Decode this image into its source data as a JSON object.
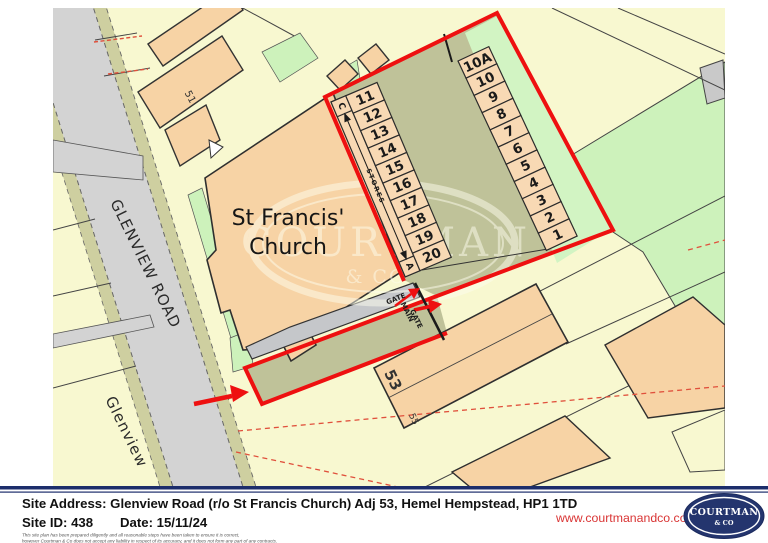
{
  "map": {
    "road_label": "GLENVIEW ROAD",
    "area_label": "Glenview",
    "church_line1": "St Francis'",
    "church_line2": "Church",
    "stores_label": "STORES",
    "store_end_top": "C",
    "store_end_bottom": "A",
    "gate_label": "GATE",
    "main_gate_line1": "MAIN",
    "main_gate_line2": "GATE",
    "house_51": "51",
    "house_53": "53",
    "house_55": "55",
    "units_left": [
      "11",
      "12",
      "13",
      "14",
      "15",
      "16",
      "17",
      "18",
      "19",
      "20"
    ],
    "units_right": [
      "10A",
      "10",
      "9",
      "8",
      "7",
      "6",
      "5",
      "4",
      "3",
      "2",
      "1"
    ],
    "watermark_line1": "COURTMAN",
    "watermark_line2": "& CO"
  },
  "footer": {
    "site_address": "Site Address: Glenview Road (r/o St Francis Church) Adj 53, Hemel Hempstead, HP1 1TD",
    "site_id": "Site ID: 438",
    "date": "Date: 15/11/24",
    "disclaimer_line1": "This site plan has been prepared diligently and all reasonable steps have been taken to ensure it is correct,",
    "disclaimer_line2": "however Courtman & Co does not accept any liability in respect of its accuracy, and it does not form any part of any contracts.",
    "website": "www.courtmanandco.com",
    "logo_line1": "COURTMAN",
    "logo_line2": "& CO"
  },
  "colors": {
    "boundary_red": "#ee1010",
    "dashed_red": "#e0503c",
    "navy": "#1c2d6b",
    "logo_navy": "#24356e",
    "link_red": "#d93434",
    "parcel_yellow": "#f8f8d0",
    "building_peach": "#f7d3a5",
    "unit_peach": "#f8d9b4",
    "courtyard_olive": "#bfc299",
    "verge_olive": "#cecfa0",
    "road_gray": "#d3d3d3",
    "path_gray": "#c5c7ca",
    "grass_green": "#cdf2bb"
  }
}
